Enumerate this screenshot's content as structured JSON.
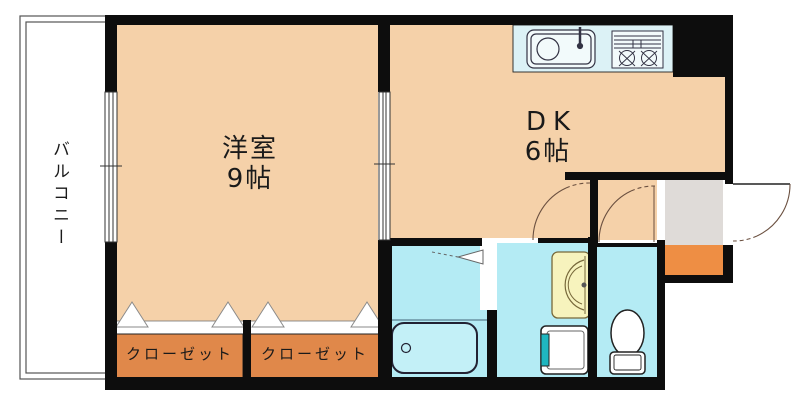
{
  "floorplan": {
    "balcony": {
      "label": "バルコニー"
    },
    "western_room": {
      "label": "洋室",
      "size": "9帖"
    },
    "dining_kitchen": {
      "label": "DK",
      "size": "6帖"
    },
    "closets": [
      {
        "label": "クローゼット"
      },
      {
        "label": "クローゼット"
      }
    ],
    "colors": {
      "room_floor": "#f5d1a9",
      "closet_fill": "#e0884a",
      "wet_area": "#b4ebf4",
      "kitchen_counter": "#dcf2f6",
      "fixture_fill": "#f2fafb",
      "entrance_floor": "#dfdbd8",
      "entrance_step": "#ee8e44",
      "vanity_fill": "#f7f3bd",
      "washer_tap": "#1fb6c0",
      "wall": "#0d0d0d",
      "door_arc": "#6b5040"
    }
  }
}
